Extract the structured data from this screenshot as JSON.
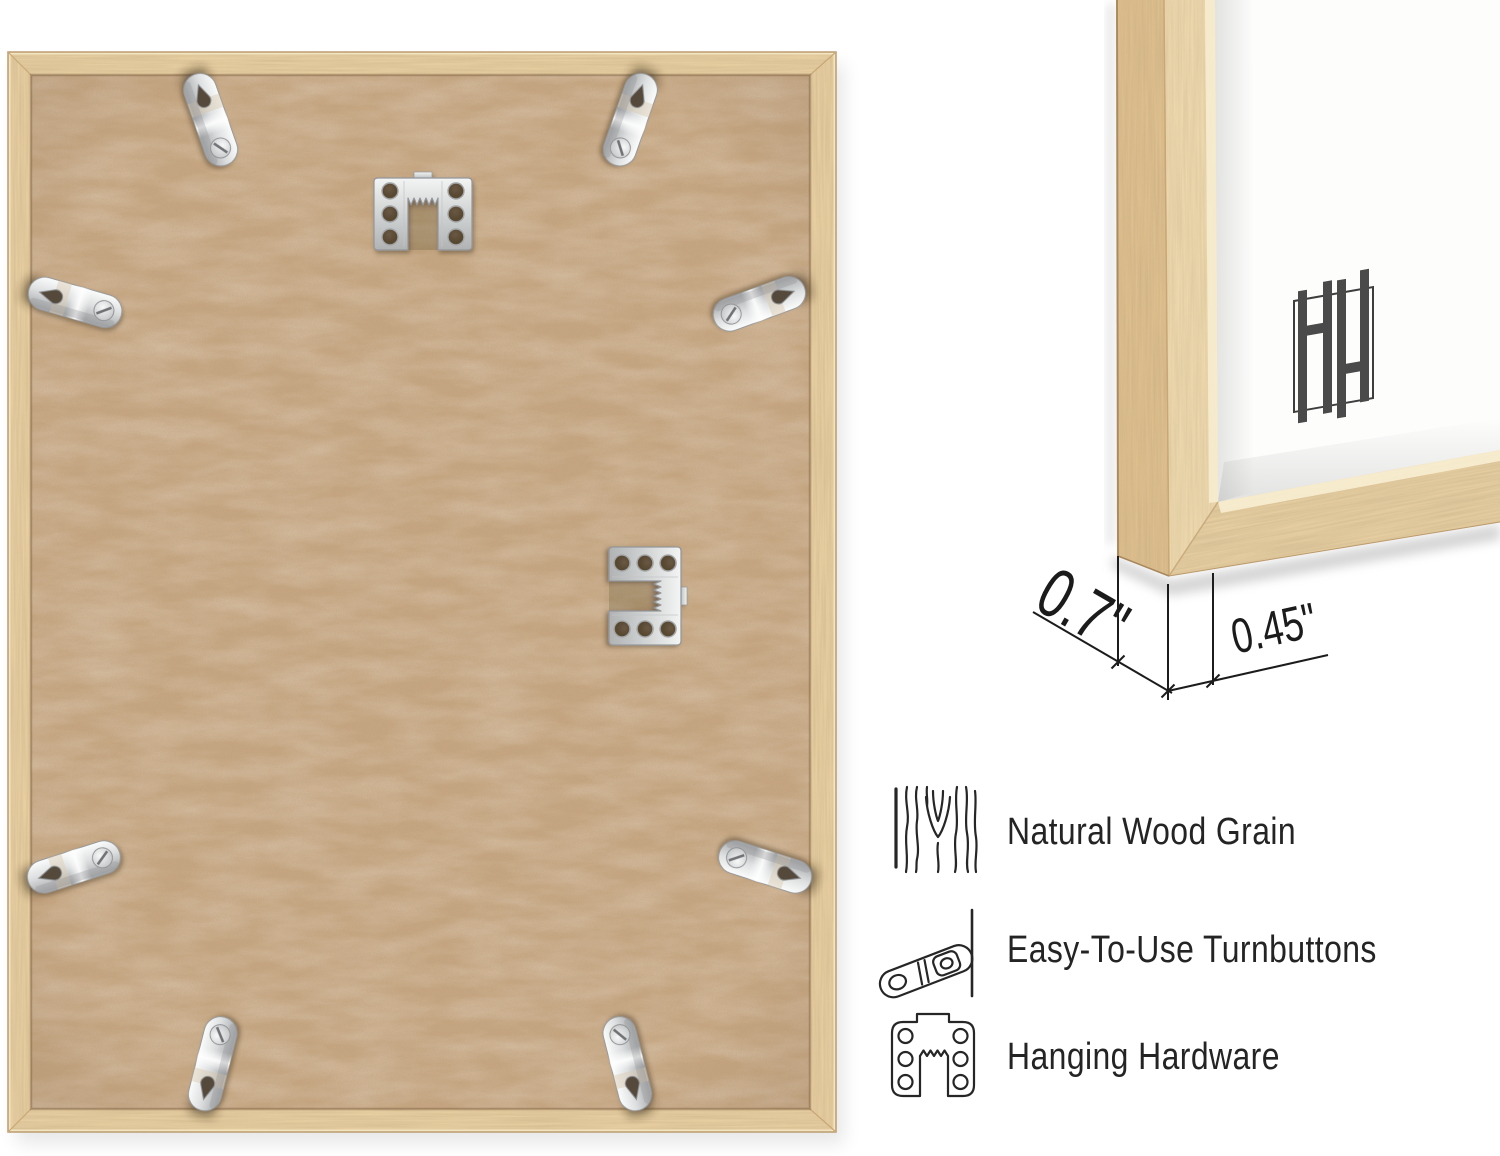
{
  "background_color": "#ffffff",
  "back_view": {
    "name": "frame-back-photo",
    "turnbutton_count": 8,
    "sawtooth_hanger_count": 2
  },
  "corner_detail": {
    "name": "frame-corner-photo",
    "depth_dimension": "0.7\"",
    "face_dimension": "0.45\"",
    "brand_logo": "double-h-monogram"
  },
  "features": [
    {
      "icon": "wood-grain-icon",
      "label": "Natural Wood Grain"
    },
    {
      "icon": "turnbutton-icon",
      "label": "Easy-To-Use Turnbuttons"
    },
    {
      "icon": "hanging-hardware-icon",
      "label": "Hanging Hardware"
    }
  ],
  "colors": {
    "wood_frame": "#e8cfa2",
    "mdf_back": "#c6a681",
    "metal_hardware": "#d9dbdc",
    "annotation_text": "#1b1b1b",
    "logo_gray": "#4a4a4a"
  }
}
